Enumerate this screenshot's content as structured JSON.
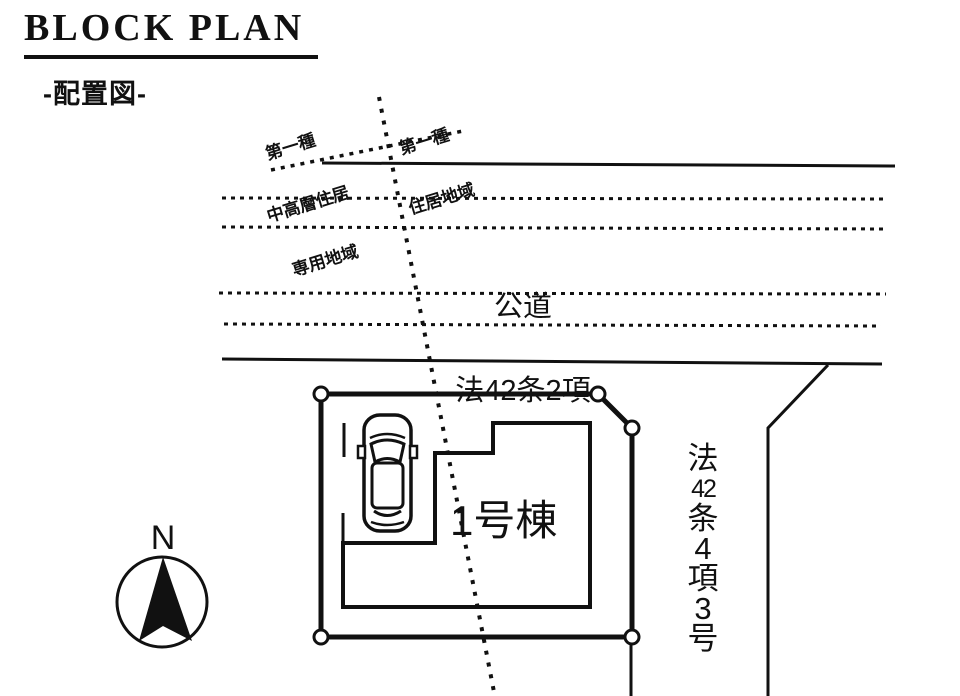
{
  "header": {
    "title": "BLOCK PLAN",
    "subtitle": "-配置図-"
  },
  "zoning": {
    "left_label_lines": [
      "第一種",
      "中高層住居",
      "専用地域"
    ],
    "right_label_lines": [
      "第一種",
      "住居地域"
    ]
  },
  "road": {
    "name": "公道",
    "law_ref": "法42条2項"
  },
  "plot": {
    "building_label": "1号棟"
  },
  "right_boundary": {
    "chars": [
      "法",
      "42",
      "条",
      "4",
      "項",
      "3",
      "号"
    ]
  },
  "compass": {
    "north": "N"
  },
  "colors": {
    "ink": "#111111",
    "background": "#ffffff"
  }
}
